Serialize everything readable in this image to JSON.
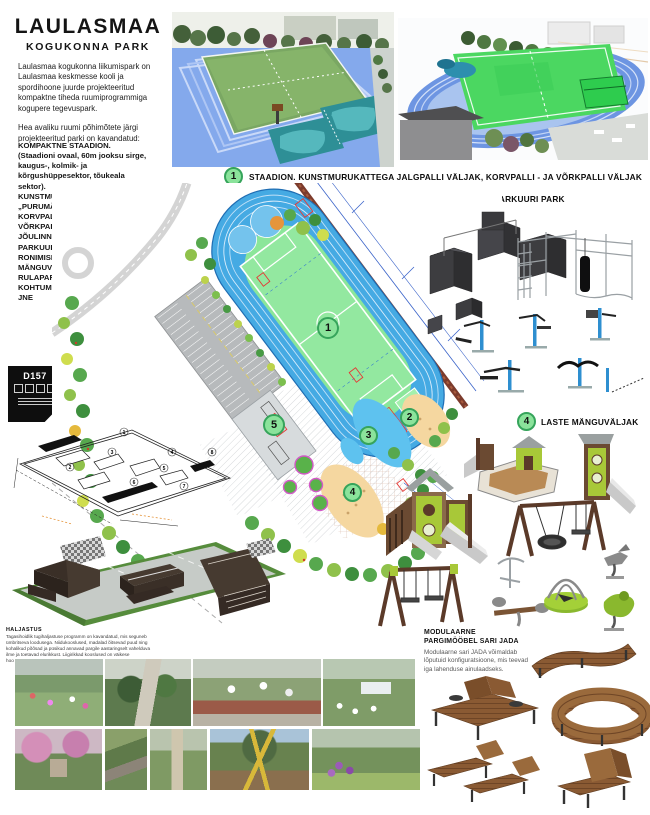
{
  "title": {
    "line1": "LAULASMAA",
    "line2": "KOGUKONNA PARK"
  },
  "intro": {
    "p1": "Laulasmaa kogukonna liikumispark on Laulasmaa keskmesse kooli ja spordihoone juurde projekteeritud kompaktne tiheda ruumiprogrammiga kogupere tegevuspark.",
    "p2": "Hea avaliku ruumi põhimõtete järgi projekteeritud parki on kavandatud:"
  },
  "features": [
    "KOMPAKTNE STAADION.",
    "(Staadioni ovaal, 60m jooksu sirge,",
    "kaugus-, kolmik- ja",
    "kõrgushüppesektor, tõukeala",
    "sektor).",
    "KUNSTMURU KATTEGA JALGPALLI JA",
    "„PURUMÄNGUDE“ VÄLJAK",
    "KORVPALLIVÄLJAK",
    "VÕRKPALLI VÄLJAK",
    "JÕULINNAK",
    "PARKUUR",
    "RONIMISEIN",
    "MÄNGUVÄLJAK",
    "RULAPARK",
    "KOHTUMISPAIK/PUHKEALA",
    "JNE"
  ],
  "callouts": {
    "c1": {
      "num": "1",
      "label": "STAADION. KUNSTMURUKATTEGA JALGPALLI VÄLJAK, KORVPALLI - JA VÕRKPALLI VÄLJAK"
    },
    "c23": {
      "numA": "2",
      "numB": "3",
      "label": "VÕIMLEMISE- /JÕULINNK JA PARKUURI PARK"
    },
    "c4": {
      "num": "4",
      "label": "LASTE MÄNGUVÄLJAK"
    },
    "c5": {
      "num": "5",
      "label": "RULAPARK"
    }
  },
  "plan": {
    "markers": {
      "m1": "1",
      "m2": "2",
      "m3": "3",
      "m4": "4",
      "m5": "5"
    }
  },
  "skatepark": {
    "badge": "D157",
    "plan_numbers": [
      "1",
      "2",
      "3",
      "4",
      "5",
      "6",
      "7",
      "8"
    ]
  },
  "furniture": {
    "heading1": "MODULAARNE",
    "heading2": "PARGIMÖÖBEL SARI JADA",
    "body": "Modulaarne sari JADA võimaldab lõputuid konfiguratsioone, mis teevad iga lahenduse ainulaadseks."
  },
  "greenery_note": {
    "heading": "HALJASTUS",
    "body": "Tagasihoidlik tugihaljastuse programm on kavandatud, mis seguneb ümbritseva loodusega. Niidukooslused, madalad õitsevad puud ning kohalikud põõsad ja püsikud annavad pargile aastaringselt vahelduva ilme ja toetavad elurikkust. Liigirikkad kooslused on väikese hooldusvajadusega, lõhnavad ja rõõmsad."
  },
  "colors": {
    "accent_green": "#8BE39B",
    "accent_green_border": "#36A45B",
    "track_blue": "#45AAE3",
    "field_green": "#93E8A0"
  }
}
